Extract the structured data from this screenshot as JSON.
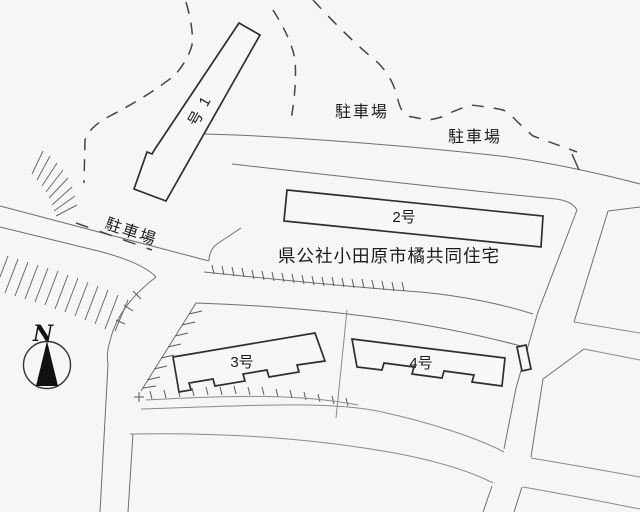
{
  "map": {
    "title": "県公社小田原市橘共同住宅",
    "buildings": [
      {
        "id": "1",
        "label": "1号"
      },
      {
        "id": "2",
        "label": "2号"
      },
      {
        "id": "3",
        "label": "3号"
      },
      {
        "id": "4",
        "label": "4号"
      }
    ],
    "parking_labels": [
      {
        "id": "west-strip",
        "text": "駐車場"
      },
      {
        "id": "top-center",
        "text": "駐車場"
      },
      {
        "id": "top-right",
        "text": "駐車場"
      }
    ],
    "compass": {
      "label": "N"
    },
    "colors": {
      "paper": "#f6f6f4",
      "line": "#6f6f6f",
      "building_line": "#2e2e2e",
      "boundary_dash": "#454545",
      "text": "#1c1c1c",
      "compass_fill": "#111111"
    }
  }
}
